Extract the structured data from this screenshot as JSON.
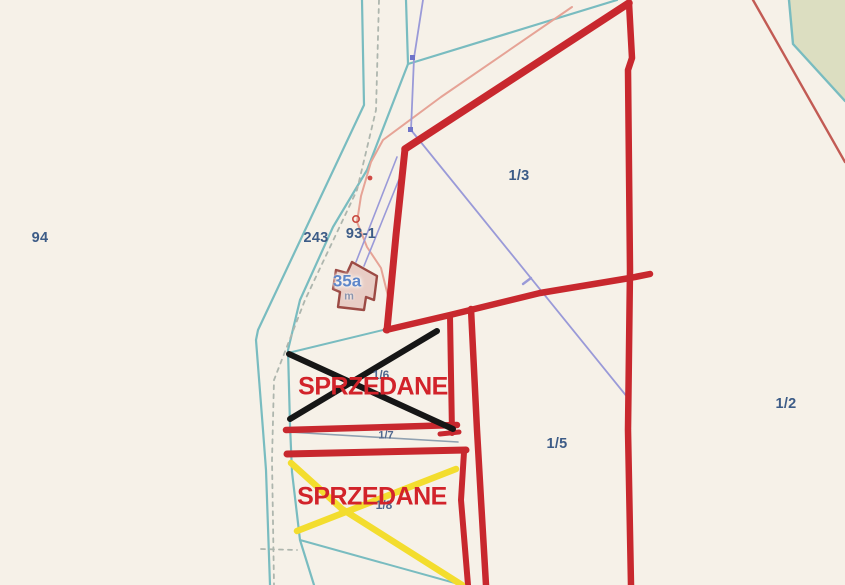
{
  "map": {
    "type_note": "cadastral parcel map with sold-parcel annotations",
    "background_color": "#f6f1e8",
    "colors": {
      "region_fill_green": "#dcdec1",
      "boundary_red": "#c8282e",
      "thin_red": "#c25b54",
      "cadastral_teal": "#79bcc0",
      "dashed_gray": "#aeb6ae",
      "power_line_salmon": "#e6a396",
      "utility_violet": "#9a9ad8",
      "marker_blue": "#6f74c9",
      "power_dot_red": "#d04a45",
      "thin_slate": "#8fa0b0",
      "cross_black": "#161616",
      "cross_yellow": "#f3dd2e",
      "label_blue": "#3d5c87",
      "label_blue_small": "#50688f",
      "sold_red": "#d2232a",
      "building_fill": "#e8cdc5",
      "building_stroke": "#9c4a44",
      "building_label_blue": "#5f87c9"
    },
    "parcel_labels": [
      {
        "id": "94",
        "text": "94"
      },
      {
        "id": "243",
        "text": "243"
      },
      {
        "id": "93-1",
        "text": "93-1"
      },
      {
        "id": "1/3",
        "text": "1/3"
      },
      {
        "id": "1/2",
        "text": "1/2"
      },
      {
        "id": "1/5",
        "text": "1/5"
      },
      {
        "id": "1/6",
        "text": "1/6"
      },
      {
        "id": "1/7",
        "text": "1/7"
      },
      {
        "id": "1/8",
        "text": "1/8"
      }
    ],
    "building": {
      "label": "35a",
      "sublabel": "m"
    },
    "sold_annotations": [
      {
        "text": "SPRZEDANE",
        "cross_color": "black"
      },
      {
        "text": "SPRZEDANE",
        "cross_color": "yellow"
      }
    ]
  }
}
